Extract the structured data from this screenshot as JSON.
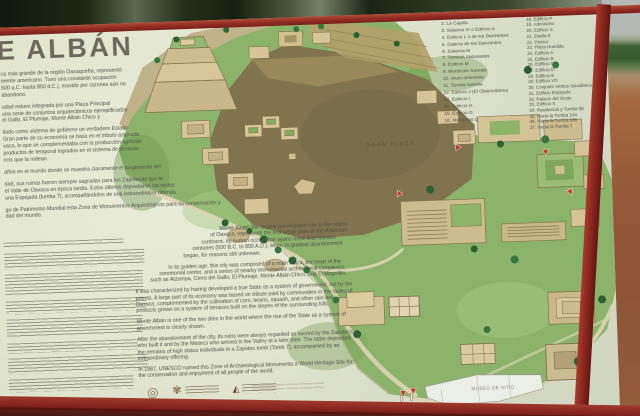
{
  "sign": {
    "title": "E ALBÁN",
    "spanish_paragraphs": [
      [
        "ca más grande de la región Oaxaqueña, representó",
        "mente americano. Tuvo una constante ocupación",
        "500 a.C. hasta 850 d.C.), movido por razones aún no",
        "abandono."
      ],
      [
        "udad estuvo integrada por una Plaza Principal",
        "una serie de conjuntos arquitectónicos ejemplificados",
        "el Gallo, El Plumaje, Monte Albán Chico y"
      ],
      [
        "llado como sistema de gobierno un verdadero Estado",
        "Gran parte de su economía se basa en el tributo asignado",
        "xaca, lo que se complementaba con la producción agrícola",
        "productos de temporal logrados en el sistema de terrazas",
        "rros que la rodean."
      ],
      [
        "años en el mundo donde se muestra claramente el surgimiento del"
      ],
      [
        "dad, sus ruinas fueron siempre sagradas para los Zapotecas que la",
        "el Valle de Oaxaca en época tardía. Estos últimos depositaron los restos",
        "una Espejada (tumba 7), acompañándolos de una extraordinaria ofrenda"
      ],
      [
        "go de Patrimonio Mundial esta Zona de Monumentos Arqueológicos para su conservación y",
        "dad del mundo."
      ]
    ],
    "english_paragraphs": [
      "Monte Albán, the largest pre-Hispanic city in the region of Oaxaca, represents the first urban plan on the American continent. Its human occupation spans more than thirteen centuries (500 B.C. to 850 A.D.), when its gradual abandonment began, for reasons still unknown.",
      "In its golden age, this city was composed of a main Plaza, the heart of the ceremonial center, and a series of nearby monumental architectural complexes, such as Atzompa, Cerro del Gallo, El Plumaje, Monte Albán Chico, and El Mogollito.",
      "It was characterized by having developed a true State as a system of government, led by the priests. A large part of its economy was based on tribute paid by communities in the Valley of Oaxaca, complemented by the cultivation of corn, beans, squash, and other rain-fed products grown on a system of terraces built on the slopes of the surrounding hills.",
      "Monte Albán is one of the two sites in the world where the rise of the State as a system of government is clearly shown.",
      "After the abandonment of the city, its ruins were always regarded as sacred by the Zapotecs who built it and by the Mixtecs who arrived in the Valley at a later date. The latter deposited the remains of high status individuals in a Zapotec tomb (Tomb 7), accompanied by an extraordinary offering.",
      "In 1987, UNESCO named this Zone of Archaeological Monuments a World Heritage Site for the conservation and enjoyment of all people of the world."
    ],
    "legend_column_1": [
      "1. Juego de Pelota",
      "2. La Capilla",
      "3. Sistema IV o Edificio K",
      "4. Edificio L o de los Danzantes",
      "5. Galería de los Danzantes",
      "6. Sistema M",
      "7. Tumbas saqueadas",
      "8. Edificio M",
      "9. Montículo Sureste",
      "10. Muro defensivo",
      "11. Tumba sureste",
      "12. Edificio J (El Observatorio)",
      "13. Edificio I",
      "14. Edificio H",
      "15. Edificio G",
      "16. Montículo Q"
    ],
    "legend_column_2": [
      "17. El Palacio",
      "18. Edificio P",
      "19. Adoratorio",
      "20. Edificio S",
      "21. Estela 9",
      "22. Pórtico",
      "23. Plaza Hundida",
      "24. Edificio A",
      "25. Edificio B",
      "26. Edificio C",
      "27. Edificio D",
      "28. Edificio E",
      "29. Edificio VG",
      "30. Conjunto Vértice Geodésico",
      "31. Edificio Enjoyado",
      "32. Palacio del Ocote",
      "33. Edificio X",
      "34. Residencia y Tumba 56",
      "35. Hacia la Tumba 104",
      "36. Hacia la Tumba 105",
      "37. Hacia la Tumba 7"
    ],
    "map_labels": {
      "plaza": "GRAN PLAZA",
      "museum": "MUSEO DE SITIO"
    },
    "footer": {
      "glyph_circle": "◎",
      "glyph_inah": "✾",
      "glyph_conaculta": "◭"
    }
  },
  "colors": {
    "frame_red": "#8e2a23",
    "sign_face": "#e4e7d2",
    "map_green": "#8cb36c",
    "plaza_brown": "#7f744e",
    "marker_red": "#c23b2f",
    "terracotta_background": "#96593a"
  }
}
